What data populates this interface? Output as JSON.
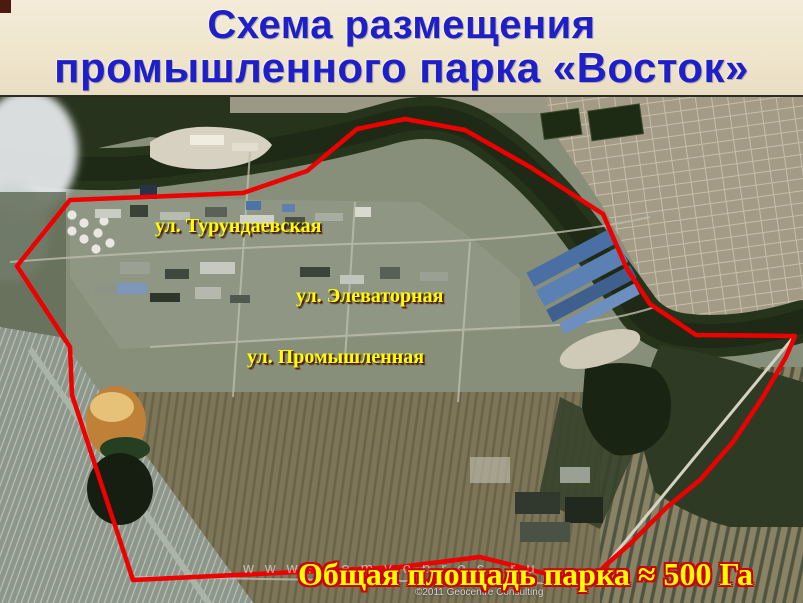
{
  "slide": {
    "title_line1": "Схема размещения",
    "title_line2": "промышленного парка «Восток»",
    "caption": "Общая площадь парка ≈ 500 Га",
    "title_color": "#1f1fc8",
    "title_background": "#efe5cc",
    "caption_fill_color": "#ffff00",
    "caption_outline_color": "#cf0000"
  },
  "map": {
    "type": "satellite-imagery-with-annotated-park-boundary",
    "street_labels": [
      {
        "text": "ул. Турундаевская"
      },
      {
        "text": "ул. Элеваторная"
      },
      {
        "text": "ул. Промышленная"
      }
    ],
    "label_color": "#ffff00",
    "boundary_color": "#ee0000",
    "polygon_points": "405,22 465,33 530,70 603,117 627,172 650,207 696,238 795,239 786,260 763,300 733,345 700,383 667,410 630,447 607,467 587,487 480,460 400,470 133,483 72,298 70,250 17,169 70,103 243,96 307,74 357,32",
    "watermark": "www.zemvopros.ru",
    "copyright": "©2011 Geocentre Consulting"
  }
}
